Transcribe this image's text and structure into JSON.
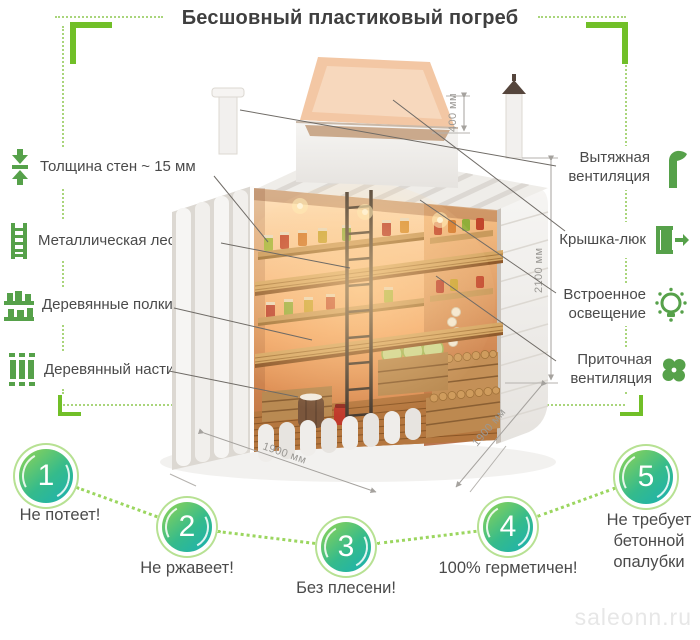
{
  "title": "Бесшовный пластиковый погреб",
  "colors": {
    "accent_green": "#71bf28",
    "light_green_dotted": "#a9d57b",
    "icon_green": "#56a14a",
    "circle_gradient_start": "#86d15b",
    "circle_gradient_end": "#1fb2ac",
    "circle_ring": "#b7e193",
    "text": "#4a4a4a",
    "dimension_gray": "#9a9894"
  },
  "features_left": [
    {
      "icon": "wall-thickness-icon",
      "label": "Толщина стен ~ 15 мм"
    },
    {
      "icon": "ladder-icon",
      "label": "Металлическая лестница"
    },
    {
      "icon": "shelves-icon",
      "label": "Деревянные полки"
    },
    {
      "icon": "flooring-icon",
      "label": "Деревянный настил"
    }
  ],
  "features_right": [
    {
      "icon": "exhaust-vent-icon",
      "label": "Вытяжная вентиляция"
    },
    {
      "icon": "hatch-icon",
      "label": "Крышка-люк"
    },
    {
      "icon": "lighting-icon",
      "label": "Встроенное освещение"
    },
    {
      "icon": "supply-vent-icon",
      "label": "Приточная вентиляция"
    }
  ],
  "dimensions": {
    "hatch_height": "400 мм",
    "body_height": "2100 мм",
    "width": "1900 мм",
    "depth": "1900 мм"
  },
  "benefits": [
    {
      "number": "1",
      "label": "Не потеет!"
    },
    {
      "number": "2",
      "label": "Не ржавеет!"
    },
    {
      "number": "3",
      "label": "Без плесени!"
    },
    {
      "number": "4",
      "label": "100% герметичен!"
    },
    {
      "number": "5",
      "label": "Не требует бетонной опалубки"
    }
  ],
  "watermark": "saleonn.ru"
}
